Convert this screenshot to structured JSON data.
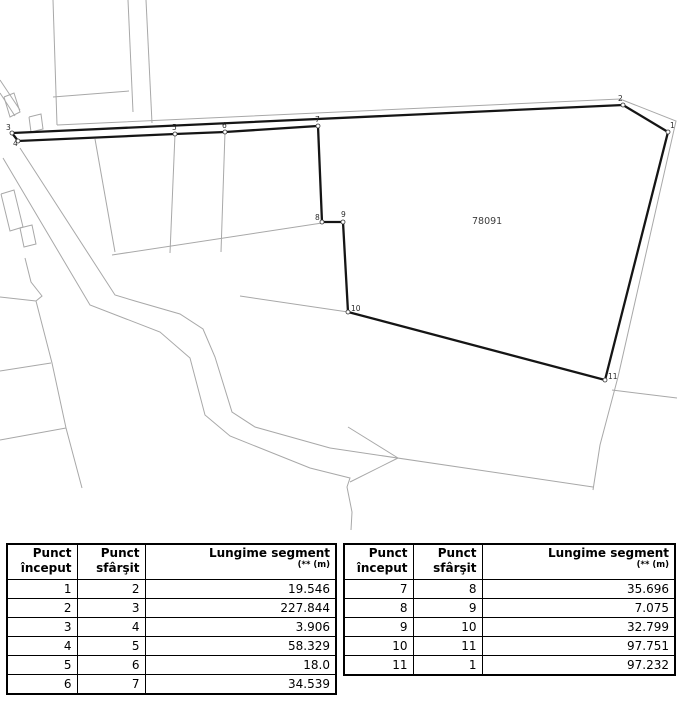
{
  "map": {
    "parcel_label": "78091",
    "parcel_label_pos": {
      "x": 472,
      "y": 224
    },
    "colors": {
      "parcel_outline": "#151515",
      "neighbor_lines": "#a8a8a8",
      "vertex_label": "#2b2b2b",
      "parcel_label": "#3c3c3c"
    },
    "vertices": [
      {
        "id": "1",
        "x": 668,
        "y": 132,
        "lx": 670,
        "ly": 128
      },
      {
        "id": "2",
        "x": 623,
        "y": 105,
        "lx": 618,
        "ly": 101
      },
      {
        "id": "3",
        "x": 12,
        "y": 133,
        "lx": 6,
        "ly": 130
      },
      {
        "id": "4",
        "x": 18,
        "y": 141,
        "lx": 13,
        "ly": 146
      },
      {
        "id": "5",
        "x": 175,
        "y": 134,
        "lx": 172,
        "ly": 130
      },
      {
        "id": "6",
        "x": 225,
        "y": 132,
        "lx": 222,
        "ly": 128
      },
      {
        "id": "7",
        "x": 318,
        "y": 126,
        "lx": 315,
        "ly": 122
      },
      {
        "id": "8",
        "x": 322,
        "y": 222,
        "lx": 315,
        "ly": 220
      },
      {
        "id": "9",
        "x": 343,
        "y": 222,
        "lx": 341,
        "ly": 217
      },
      {
        "id": "10",
        "x": 348,
        "y": 312,
        "lx": 351,
        "ly": 311
      },
      {
        "id": "11",
        "x": 605,
        "y": 380,
        "lx": 608,
        "ly": 379
      }
    ],
    "background_lines": [
      [
        [
          53,
          0
        ],
        [
          57,
          125
        ]
      ],
      [
        [
          128,
          0
        ],
        [
          133,
          112
        ]
      ],
      [
        [
          146,
          0
        ],
        [
          152,
          123
        ]
      ],
      [
        [
          53,
          97
        ],
        [
          129,
          91
        ]
      ],
      [
        [
          57,
          125
        ],
        [
          620,
          99
        ],
        [
          676,
          121
        ],
        [
          618,
          377
        ],
        [
          600,
          445
        ],
        [
          593,
          490
        ]
      ],
      [
        [
          612,
          390
        ],
        [
          677,
          398
        ]
      ],
      [
        [
          330,
          448
        ],
        [
          593,
          487
        ]
      ],
      [
        [
          20,
          148
        ],
        [
          115,
          295
        ],
        [
          135,
          301
        ],
        [
          180,
          314
        ],
        [
          203,
          329
        ],
        [
          215,
          357
        ],
        [
          232,
          412
        ],
        [
          255,
          427
        ],
        [
          330,
          448
        ]
      ],
      [
        [
          3,
          158
        ],
        [
          90,
          305
        ],
        [
          160,
          332
        ],
        [
          190,
          358
        ],
        [
          205,
          415
        ],
        [
          230,
          436
        ],
        [
          310,
          468
        ],
        [
          350,
          478
        ],
        [
          347,
          487
        ],
        [
          352,
          512
        ],
        [
          351,
          530
        ]
      ],
      [
        [
          175,
          134
        ],
        [
          170,
          253
        ]
      ],
      [
        [
          225,
          132
        ],
        [
          221,
          252
        ]
      ],
      [
        [
          112,
          255
        ],
        [
          322,
          223
        ]
      ],
      [
        [
          95,
          139
        ],
        [
          115,
          252
        ]
      ],
      [
        [
          240,
          296
        ],
        [
          348,
          312
        ]
      ],
      [
        [
          0,
          297
        ],
        [
          36,
          301
        ]
      ],
      [
        [
          36,
          301
        ],
        [
          52,
          363
        ],
        [
          66,
          428
        ],
        [
          82,
          488
        ]
      ],
      [
        [
          0,
          371
        ],
        [
          51,
          363
        ]
      ],
      [
        [
          0,
          440
        ],
        [
          66,
          428
        ]
      ],
      [
        [
          25,
          258
        ],
        [
          31,
          282
        ],
        [
          42,
          296
        ],
        [
          36,
          301
        ]
      ],
      [
        [
          0,
          80
        ],
        [
          20,
          110
        ]
      ],
      [
        [
          0,
          93
        ],
        [
          15,
          116
        ]
      ],
      [
        [
          4,
          97
        ],
        [
          14,
          93
        ],
        [
          20,
          112
        ],
        [
          10,
          117
        ],
        [
          4,
          97
        ]
      ],
      [
        [
          29,
          117
        ],
        [
          41,
          114
        ],
        [
          43,
          129
        ],
        [
          31,
          132
        ],
        [
          29,
          117
        ]
      ],
      [
        [
          348,
          427
        ],
        [
          398,
          458
        ]
      ],
      [
        [
          398,
          458
        ],
        [
          350,
          482
        ]
      ],
      [
        [
          1,
          194
        ],
        [
          14,
          190
        ],
        [
          23,
          227
        ],
        [
          10,
          231
        ],
        [
          1,
          194
        ]
      ],
      [
        [
          20,
          228
        ],
        [
          32,
          225
        ],
        [
          36,
          244
        ],
        [
          24,
          247
        ],
        [
          20,
          228
        ]
      ]
    ]
  },
  "tables": {
    "headers": {
      "start_line1": "Punct",
      "start_line2": "început",
      "end_line1": "Punct",
      "end_line2": "sfârşit",
      "len_line1": "Lungime segment",
      "len_line2": "(** (m)"
    },
    "left_rows": [
      [
        "1",
        "2",
        "19.546"
      ],
      [
        "2",
        "3",
        "227.844"
      ],
      [
        "3",
        "4",
        "3.906"
      ],
      [
        "4",
        "5",
        "58.329"
      ],
      [
        "5",
        "6",
        "18.0"
      ],
      [
        "6",
        "7",
        "34.539"
      ]
    ],
    "right_rows": [
      [
        "7",
        "8",
        "35.696"
      ],
      [
        "8",
        "9",
        "7.075"
      ],
      [
        "9",
        "10",
        "32.799"
      ],
      [
        "10",
        "11",
        "97.751"
      ],
      [
        "11",
        "1",
        "97.232"
      ]
    ]
  }
}
